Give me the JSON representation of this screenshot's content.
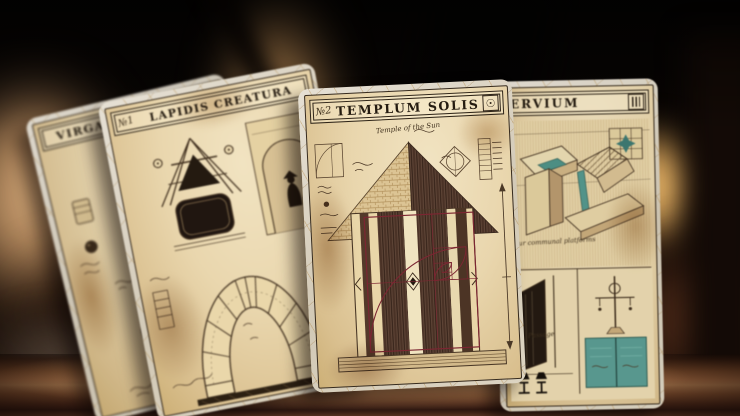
{
  "cards": {
    "virga": {
      "title": "VIRGA TRITONIS"
    },
    "lapidis": {
      "number": "№1",
      "title": "LAPIDIS CREATURA"
    },
    "templum": {
      "number": "№2",
      "title": "TEMPLUM SOLIS",
      "subtitle": "Temple of the Sun"
    },
    "servium": {
      "title": "ERVIUM",
      "note_platforms": "four communal platforms",
      "note_passage": "Passage"
    }
  },
  "icons": {
    "sun": {
      "name": "sun-icon",
      "glyph": "☉"
    },
    "columns": {
      "name": "columns-icon"
    },
    "square": {
      "name": "square-icon"
    }
  },
  "colors": {
    "parchment": "#ecd9ae",
    "ink": "#2b2014",
    "maroon_overlay": "#7c2632",
    "teal_accent": "#4f9287",
    "card_edge": "#d9d2c4",
    "table_wood": "#b5764a",
    "candle_glow": "#f2c577",
    "background": "#0a0603"
  }
}
